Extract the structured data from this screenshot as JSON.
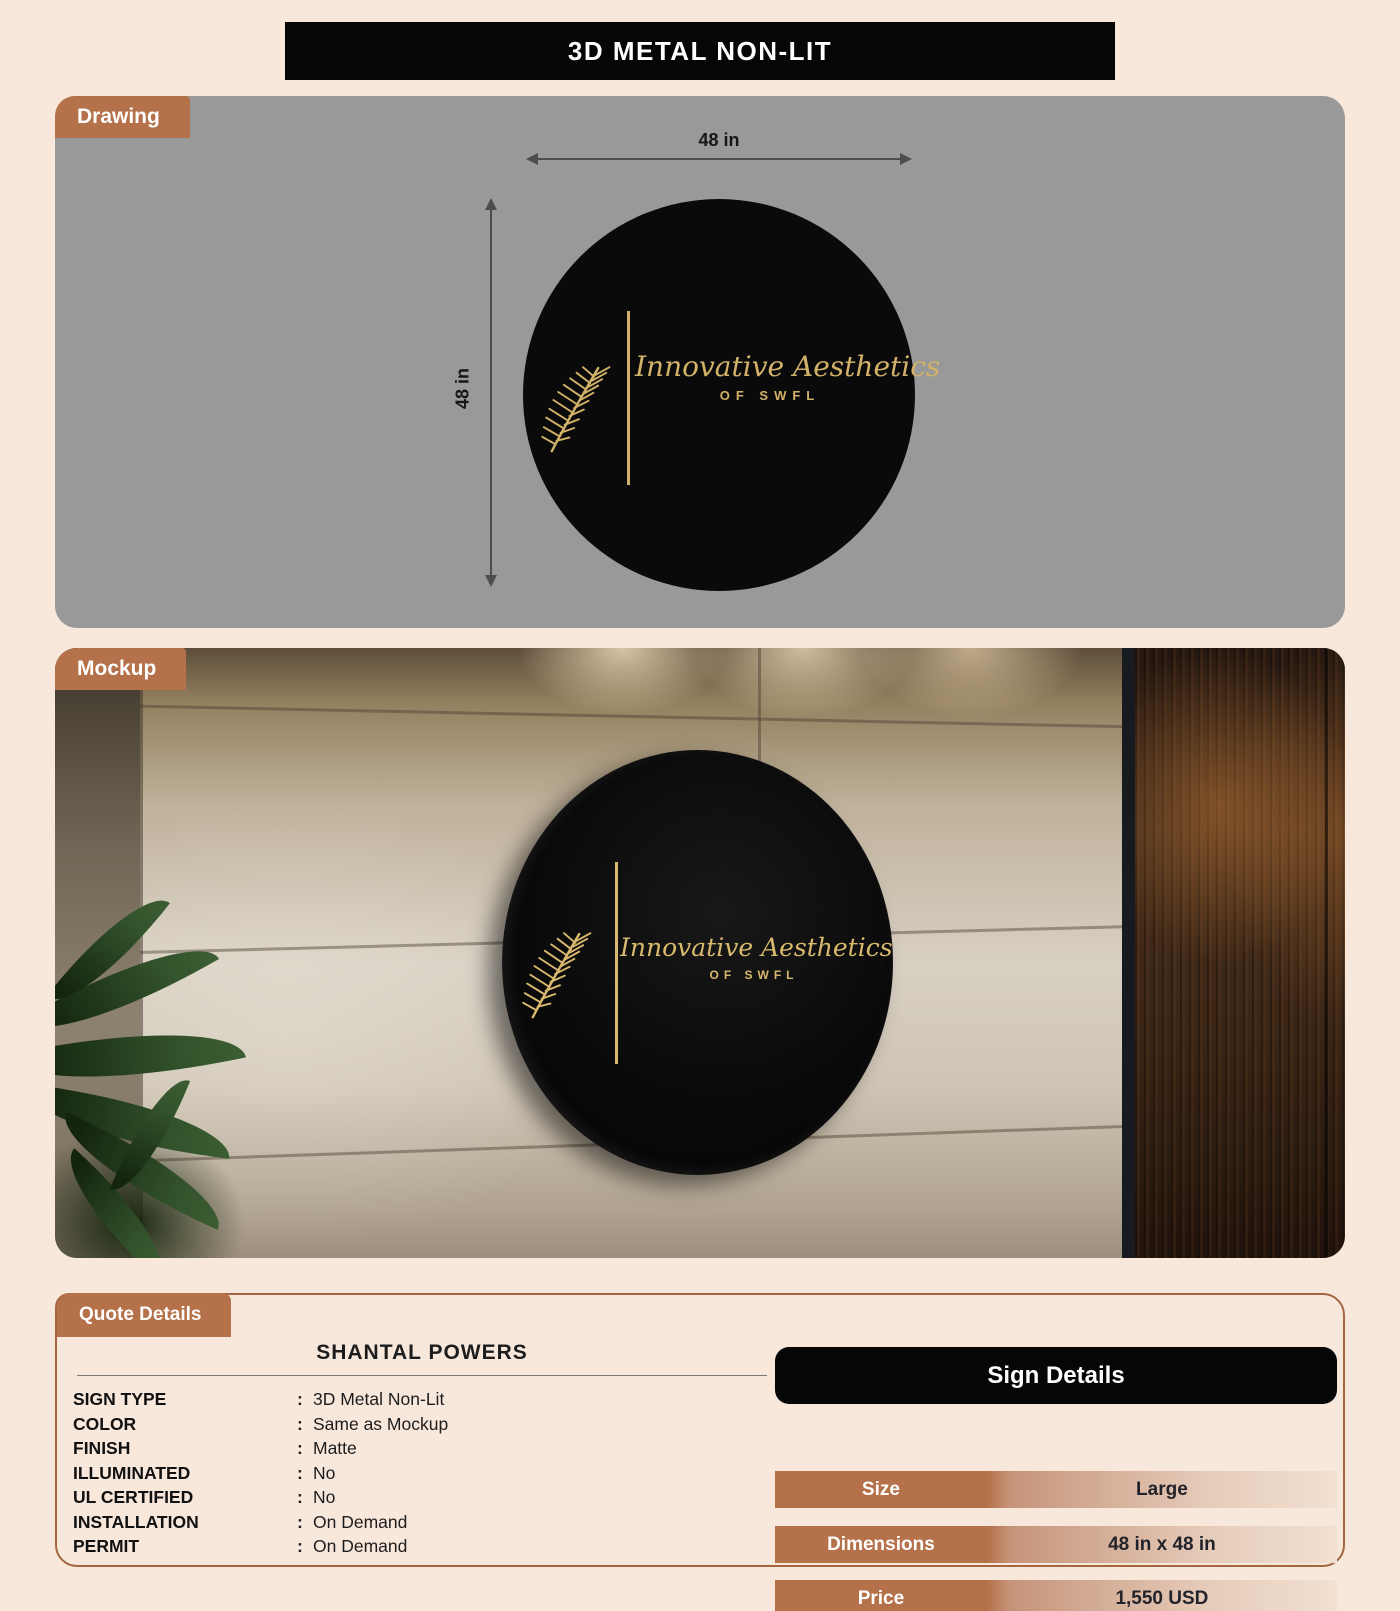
{
  "title": "3D METAL NON-LIT",
  "colors": {
    "accent": "#b5714a",
    "gold": "#d2b269",
    "panel_gray": "#999999",
    "page_bg": "#f8e7db",
    "header_black": "#060606"
  },
  "drawing": {
    "tab": "Drawing",
    "width_label": "48 in",
    "height_label": "48 in"
  },
  "mockup": {
    "tab": "Mockup"
  },
  "logo": {
    "name": "Innovative Aesthetics",
    "sub": "OF SWFL",
    "icon": "palm-leaf-icon"
  },
  "quote": {
    "tab": "Quote Details",
    "customer": "SHANTAL POWERS",
    "colon": ":",
    "fields": [
      {
        "label": "SIGN TYPE",
        "value": "3D Metal Non-Lit"
      },
      {
        "label": "COLOR",
        "value": "Same as Mockup"
      },
      {
        "label": "FINISH",
        "value": "Matte"
      },
      {
        "label": "ILLUMINATED",
        "value": "No"
      },
      {
        "label": "UL CERTIFIED",
        "value": "No"
      },
      {
        "label": "INSTALLATION",
        "value": "On Demand"
      },
      {
        "label": "PERMIT",
        "value": "On Demand"
      }
    ]
  },
  "sign_details": {
    "header": "Sign Details",
    "rows": [
      {
        "label": "Size",
        "value": "Large"
      },
      {
        "label": "Dimensions",
        "value": "48 in x 48 in"
      },
      {
        "label": "Price",
        "value": "1,550 USD"
      }
    ]
  }
}
